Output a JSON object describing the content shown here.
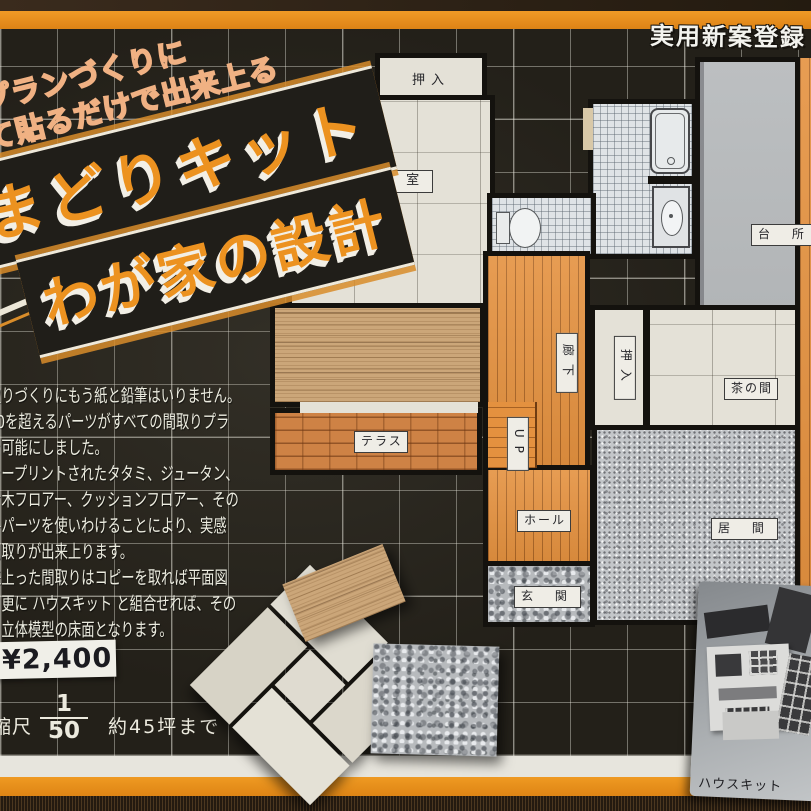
{
  "registration_badge": "実用新案登録",
  "banner": {
    "tagline1": "プランづくりに",
    "tagline2": "並べて貼るだけで出来上る",
    "title1": "まどりキット",
    "title2": "わが家の設計"
  },
  "description_lines": [
    "取りづくりにもう紙と鉛筆はいりません。",
    "50を超えるパーツがすべての間取りプラ",
    "を可能にしました。",
    "ラープリントされたタタミ、ジュータン、",
    "せ木フロアー、クッションフロアー、その",
    "各パーツを使いわけることにより、実感",
    "間取りが出来上ります。",
    "来上った間取りはコピーを取れば平面図",
    "、更に ハウスキット と組合せれば、その",
    "、立体模型の床面となります。"
  ],
  "price": "¥2,400",
  "scale": {
    "label": "縮尺",
    "numerator": "1",
    "denominator": "50",
    "coverage": "約45坪まで"
  },
  "floor_plan": {
    "closet_top": "押入",
    "guest_room": "客 室",
    "kitchen": "台 所",
    "corridor": "廊下",
    "closet_side": "押入",
    "tea_room": "茶の間",
    "terrace": "テラス",
    "stairs": "UP",
    "hall": "ホール",
    "entrance": "玄 関",
    "living_room": "居 間"
  },
  "photo_caption": "ハウスキット",
  "colors": {
    "box_orange": "#e8901f",
    "blueprint_black": "#232019",
    "floor_orange": "#e4913f",
    "tatami_cream": "#e4e1d7"
  }
}
